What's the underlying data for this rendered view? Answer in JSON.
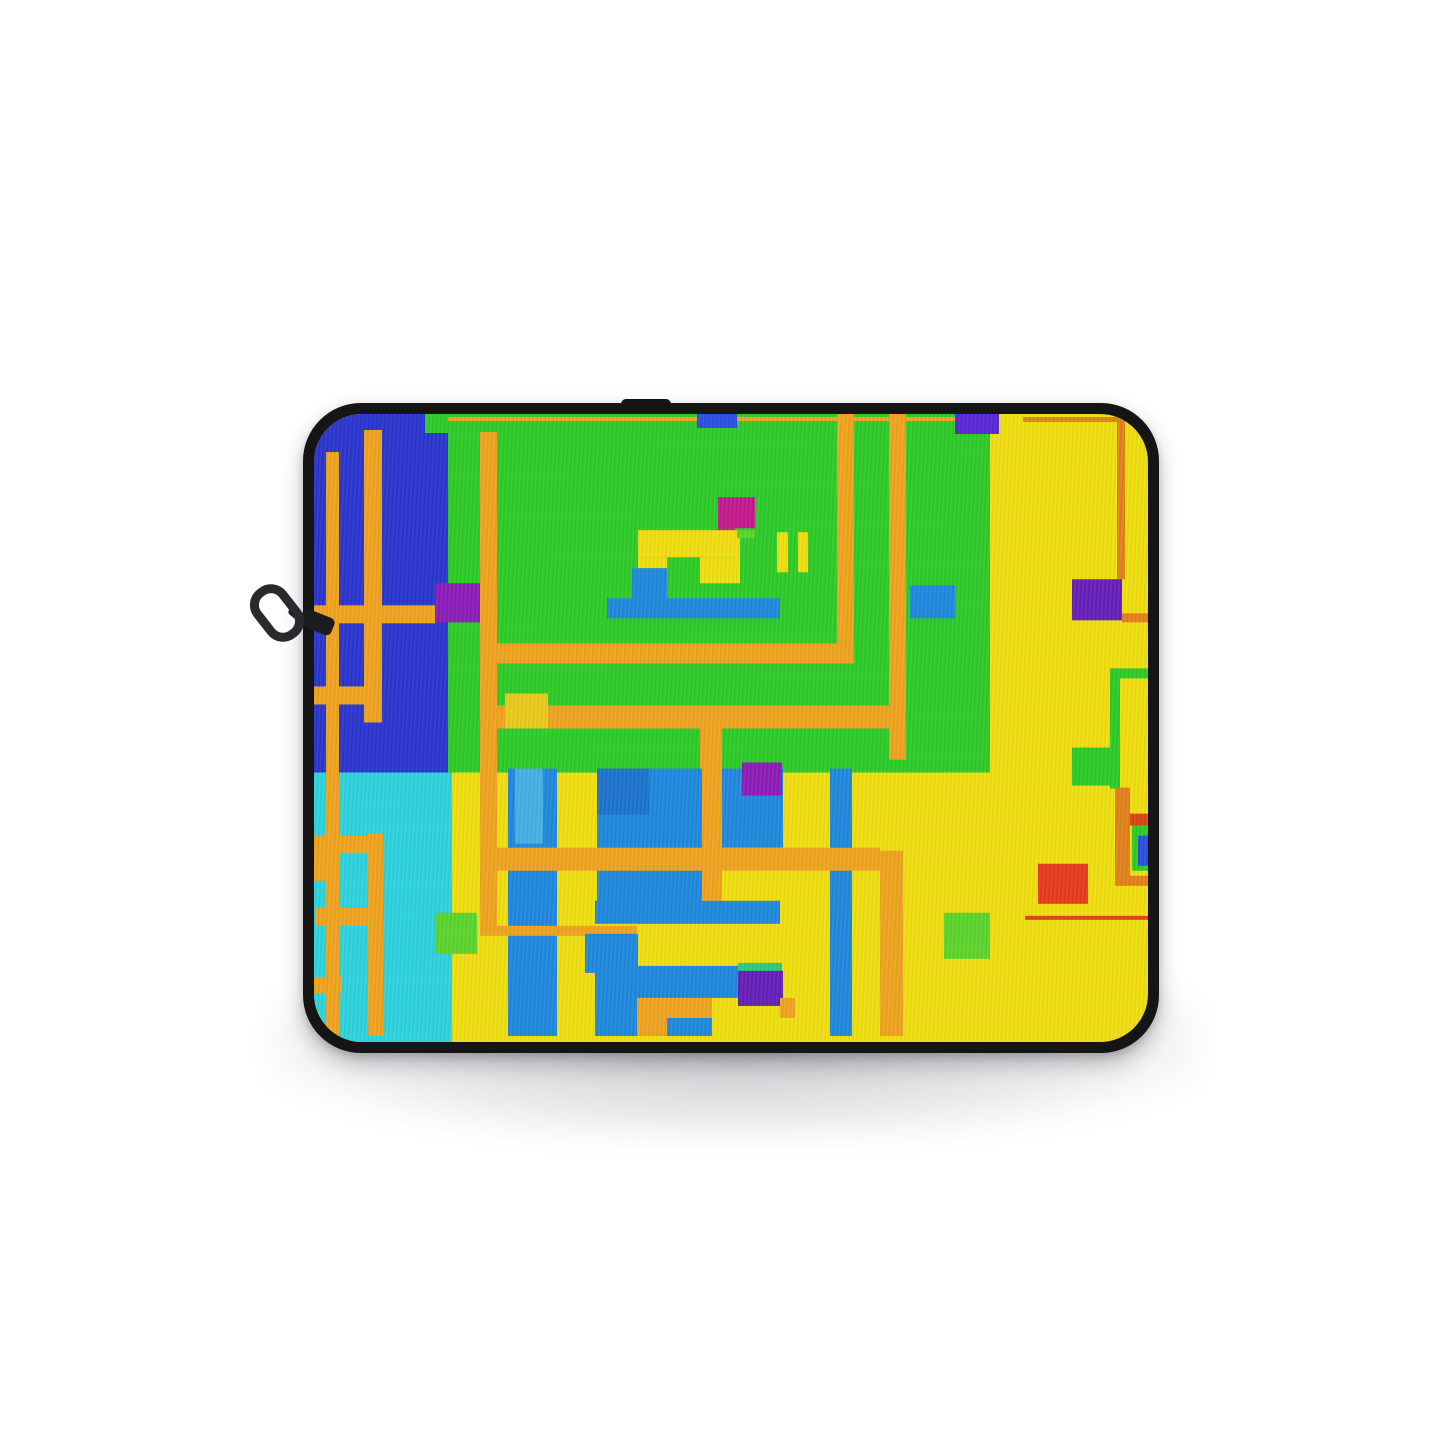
{
  "scene": {
    "type": "product-photo",
    "product": "laptop-sleeve",
    "orientation": "front view, zipper on upper left edge",
    "background_color": "#ffffff",
    "art_style": "abstract geometric pixel blocks"
  },
  "sleeve": {
    "border_color": "#151515",
    "zipper_color": "#1c1c1f",
    "zipper_metal_color": "#2a2a2e"
  },
  "palette": {
    "yellow": "#f0df10",
    "yellow_deep": "#e9ca1e",
    "green": "#2ecb28",
    "green_light": "#5cd42c",
    "green_spring": "#2fc97c",
    "blue_royal": "#2a36cf",
    "blue_royal_bright": "#2d4fe0",
    "blue": "#2089dd",
    "blue_dark": "#1e74ce",
    "blue_light": "#45b0e5",
    "cyan": "#2ed3df",
    "orange": "#efa31f",
    "orange_dark": "#e2821a",
    "red": "#e73a1e",
    "red_line": "#d94513",
    "magenta": "#c41a8e",
    "purple": "#8d1cb8",
    "purple_deep": "#6620b8",
    "indigo": "#5a26d6"
  },
  "artwork": {
    "width": 834,
    "height": 627,
    "shapes": [
      [
        "base-yellow-field",
        0,
        0,
        834,
        627,
        "yellow"
      ],
      [
        "left-blue-block",
        0,
        0,
        134,
        358,
        "blue_royal"
      ],
      [
        "left-blue-top-green-notch",
        111,
        0,
        23,
        19,
        "green"
      ],
      [
        "green-field",
        134,
        0,
        542,
        358,
        "green"
      ],
      [
        "cyan-block",
        0,
        358,
        138,
        269,
        "cyan"
      ],
      [
        "yellow-column-left",
        138,
        358,
        21,
        269,
        "yellow"
      ],
      [
        "orange-stripe-a",
        12,
        38,
        13,
        320,
        "orange"
      ],
      [
        "orange-stripe-b",
        50,
        16,
        18,
        292,
        "orange"
      ],
      [
        "orange-band-left-upper",
        0,
        191,
        121,
        18,
        "orange"
      ],
      [
        "orange-band-left-lower",
        0,
        272,
        50,
        18,
        "orange"
      ],
      [
        "purple-square-left",
        121,
        169,
        50,
        39,
        "purple"
      ],
      [
        "orange-stripe-a2",
        12,
        358,
        13,
        263,
        "orange"
      ],
      [
        "window-rung-top",
        0,
        421,
        69,
        17,
        "orange"
      ],
      [
        "window-side",
        54,
        419,
        15,
        202,
        "orange"
      ],
      [
        "window-rung-bottom",
        1,
        493,
        68,
        18,
        "orange"
      ],
      [
        "window-block",
        0,
        421,
        16,
        45,
        "orange"
      ],
      [
        "orange-seg-bottom-left",
        0,
        562,
        28,
        16,
        "orange"
      ],
      [
        "green-square-cyan",
        121,
        498,
        42,
        41,
        "green_light"
      ],
      [
        "orange-top-line",
        134,
        3,
        542,
        4,
        "orange"
      ],
      [
        "orange-stripe-c",
        166,
        18,
        17,
        493,
        "orange"
      ],
      [
        "orange-stripe-d",
        523,
        0,
        17,
        229,
        "orange"
      ],
      [
        "orange-stripe-e",
        575,
        0,
        17,
        345,
        "orange"
      ],
      [
        "orange-band-mid-1",
        166,
        229,
        374,
        20,
        "orange"
      ],
      [
        "orange-band-mid-2",
        183,
        291,
        408,
        23,
        "orange"
      ],
      [
        "orange-stripe-f",
        386,
        314,
        22,
        172,
        "orange"
      ],
      [
        "yellow-square-mid",
        191,
        279,
        43,
        35,
        "yellow_deep"
      ],
      [
        "blue-square-top",
        383,
        0,
        40,
        14,
        "blue_royal_bright"
      ],
      [
        "purple-square-top",
        641,
        0,
        44,
        20,
        "indigo"
      ],
      [
        "blue-square-green",
        596,
        171,
        45,
        33,
        "blue"
      ],
      [
        "magenta-square",
        404,
        83,
        37,
        31,
        "magenta"
      ],
      [
        "magenta-tail",
        404,
        114,
        17,
        9,
        "magenta"
      ],
      [
        "motif-yellow-bar",
        324,
        116,
        102,
        27,
        "yellow"
      ],
      [
        "motif-yellow-left",
        324,
        143,
        29,
        11,
        "yellow"
      ],
      [
        "motif-yellow-right",
        386,
        143,
        40,
        26,
        "yellow"
      ],
      [
        "motif-green-smudge",
        423,
        116,
        18,
        8,
        "green_light"
      ],
      [
        "motif-blue-foot",
        318,
        154,
        35,
        32,
        "blue"
      ],
      [
        "motif-blue-base",
        293,
        184,
        173,
        20,
        "blue"
      ],
      [
        "yellow-bar-1",
        463,
        118,
        11,
        40,
        "yellow"
      ],
      [
        "yellow-bar-2",
        484,
        118,
        10,
        40,
        "yellow"
      ],
      [
        "blue-col-1",
        194,
        354,
        49,
        267,
        "blue"
      ],
      [
        "blue-col-1-light",
        201,
        354,
        28,
        75,
        "blue_light"
      ],
      [
        "blue-col-2",
        283,
        354,
        105,
        140,
        "blue"
      ],
      [
        "blue-col-2-dark",
        283,
        354,
        52,
        46,
        "blue_dark"
      ],
      [
        "blue-col-3",
        408,
        354,
        61,
        79,
        "blue"
      ],
      [
        "purple-square-cols",
        428,
        348,
        40,
        33,
        "purple"
      ],
      [
        "blue-col-4",
        516,
        354,
        22,
        267,
        "blue"
      ],
      [
        "orange-band-low-1",
        166,
        433,
        400,
        23,
        "orange"
      ],
      [
        "blue-rect-wide",
        281,
        486,
        185,
        23,
        "blue"
      ],
      [
        "orange-band-low-2",
        166,
        511,
        157,
        10,
        "orange"
      ],
      [
        "blue-square-low",
        271,
        519,
        53,
        39,
        "blue"
      ],
      [
        "blue-L-top",
        281,
        551,
        143,
        32,
        "blue"
      ],
      [
        "blue-L-left",
        281,
        583,
        42,
        38,
        "blue"
      ],
      [
        "blue-L-bottom",
        353,
        603,
        45,
        18,
        "blue"
      ],
      [
        "orange-inner-1",
        323,
        583,
        75,
        20,
        "orange"
      ],
      [
        "orange-inner-2",
        323,
        603,
        30,
        18,
        "orange"
      ],
      [
        "spring-strip",
        424,
        548,
        44,
        10,
        "green_spring"
      ],
      [
        "purple-square-bottom",
        424,
        556,
        45,
        35,
        "purple_deep"
      ],
      [
        "orange-piece",
        466,
        583,
        15,
        20,
        "orange"
      ],
      [
        "orange-stripe-g",
        566,
        436,
        23,
        185,
        "orange"
      ],
      [
        "orange-vline-right",
        803,
        3,
        8,
        162,
        "orange_dark"
      ],
      [
        "orange-top-line-right",
        709,
        3,
        94,
        5,
        "orange_dark"
      ],
      [
        "purple-square-right",
        758,
        165,
        50,
        41,
        "purple_deep"
      ],
      [
        "orange-hseg-right",
        808,
        199,
        26,
        9,
        "orange_dark"
      ],
      [
        "green-frame-v",
        796,
        254,
        10,
        120,
        "green"
      ],
      [
        "green-frame-h",
        796,
        254,
        38,
        10,
        "green"
      ],
      [
        "green-square-right",
        758,
        333,
        45,
        38,
        "green"
      ],
      [
        "orange-frame-v",
        801,
        373,
        15,
        98,
        "orange_dark"
      ],
      [
        "orange-frame-h",
        803,
        461,
        31,
        10,
        "orange_dark"
      ],
      [
        "orangered-bar",
        816,
        399,
        18,
        12,
        "red_line"
      ],
      [
        "green-panel",
        818,
        411,
        16,
        45,
        "green"
      ],
      [
        "blue-panel",
        824,
        421,
        10,
        30,
        "blue_royal_bright"
      ],
      [
        "red-square",
        724,
        449,
        50,
        40,
        "red"
      ],
      [
        "red-line",
        711,
        501,
        123,
        4,
        "red_line"
      ],
      [
        "green-square-light",
        630,
        498,
        46,
        46,
        "green_light"
      ]
    ]
  }
}
